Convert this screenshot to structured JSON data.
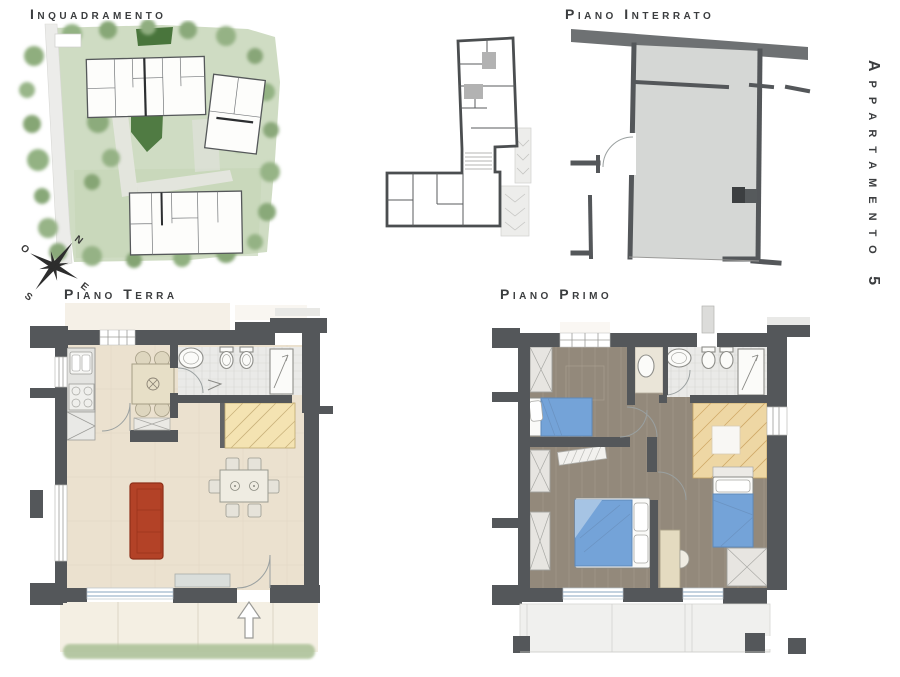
{
  "labels": {
    "site_plan": "Inquadramento",
    "basement": "Piano Interrato",
    "ground_floor": "Piano Terra",
    "first_floor": "Piano Primo",
    "apartment": "Appartamento 5"
  },
  "compass": {
    "n": "N",
    "e": "E",
    "s": "S",
    "o": "O"
  },
  "colors": {
    "ink": "#3b3d3f",
    "wall": "#54575a",
    "floor_beige": "#ebe1cf",
    "floor_wood": "#93897b",
    "floor_bath": "#eaeae8",
    "stairs_terra": "#f4e3b2",
    "stairs_primo": "#eed7a4",
    "sofa_red": "#b34227",
    "bed_blue": "#74a3d8",
    "table_beige": "#e7dfc7",
    "gray_fill": "#d5d7d5",
    "window_blue": "#9fb8cc",
    "grass": "#aec29a",
    "site_green": "#cfdcc3",
    "site_green_dark": "#49753c"
  }
}
